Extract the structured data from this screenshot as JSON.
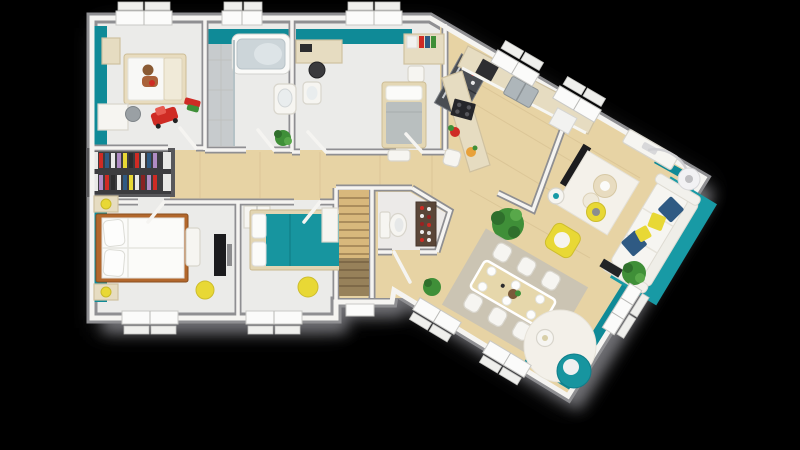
{
  "scene": {
    "label": "3d-house-floor-plan-top-view",
    "width": 800,
    "height": 450,
    "background": "#000000"
  },
  "colors": {
    "background": "#000000",
    "shadow": "#77777b",
    "shadow_soft": "#515156",
    "wall_outer": "#8f8f92",
    "wall_face": "#f5f4f1",
    "floor_white": "#ebebe9",
    "floor_tile": "#c7cbcd",
    "wood": "#e7d3a4",
    "stair_wood": "#d8b87c",
    "teal": "#0f8a97",
    "teal_rug": "#189aa5",
    "teal_bed": "#17959f",
    "closet_dark": "#3c3c3f",
    "furn_white": "#f6f5f1",
    "furn_stroke": "#d8d5cc",
    "counter": "#e6dcc1",
    "counter_edge": "#cfc1a0",
    "bed_brown": "#b2672c",
    "duvet_white": "#fbfbf9",
    "blanket_gray": "#b9bfbf",
    "navy": "#2f5a83",
    "yellow": "#e8d835",
    "green": "#3f8f38",
    "green_dark": "#2f6f2c",
    "red": "#cf2b24",
    "appliance_dark": "#2e2e31",
    "steel": "#4a4d52",
    "rug_white": "#f4f1ea",
    "rug_gray": "#c8c2b5",
    "table_beige": "#e6d7ab"
  },
  "rooms": [
    {
      "name": "child-bedroom"
    },
    {
      "name": "bathroom"
    },
    {
      "name": "study-bedroom"
    },
    {
      "name": "wardrobe-closet"
    },
    {
      "name": "hallway"
    },
    {
      "name": "master-bedroom"
    },
    {
      "name": "second-bedroom"
    },
    {
      "name": "staircase"
    },
    {
      "name": "wc"
    },
    {
      "name": "kitchen"
    },
    {
      "name": "dining-area"
    },
    {
      "name": "living-room"
    }
  ]
}
